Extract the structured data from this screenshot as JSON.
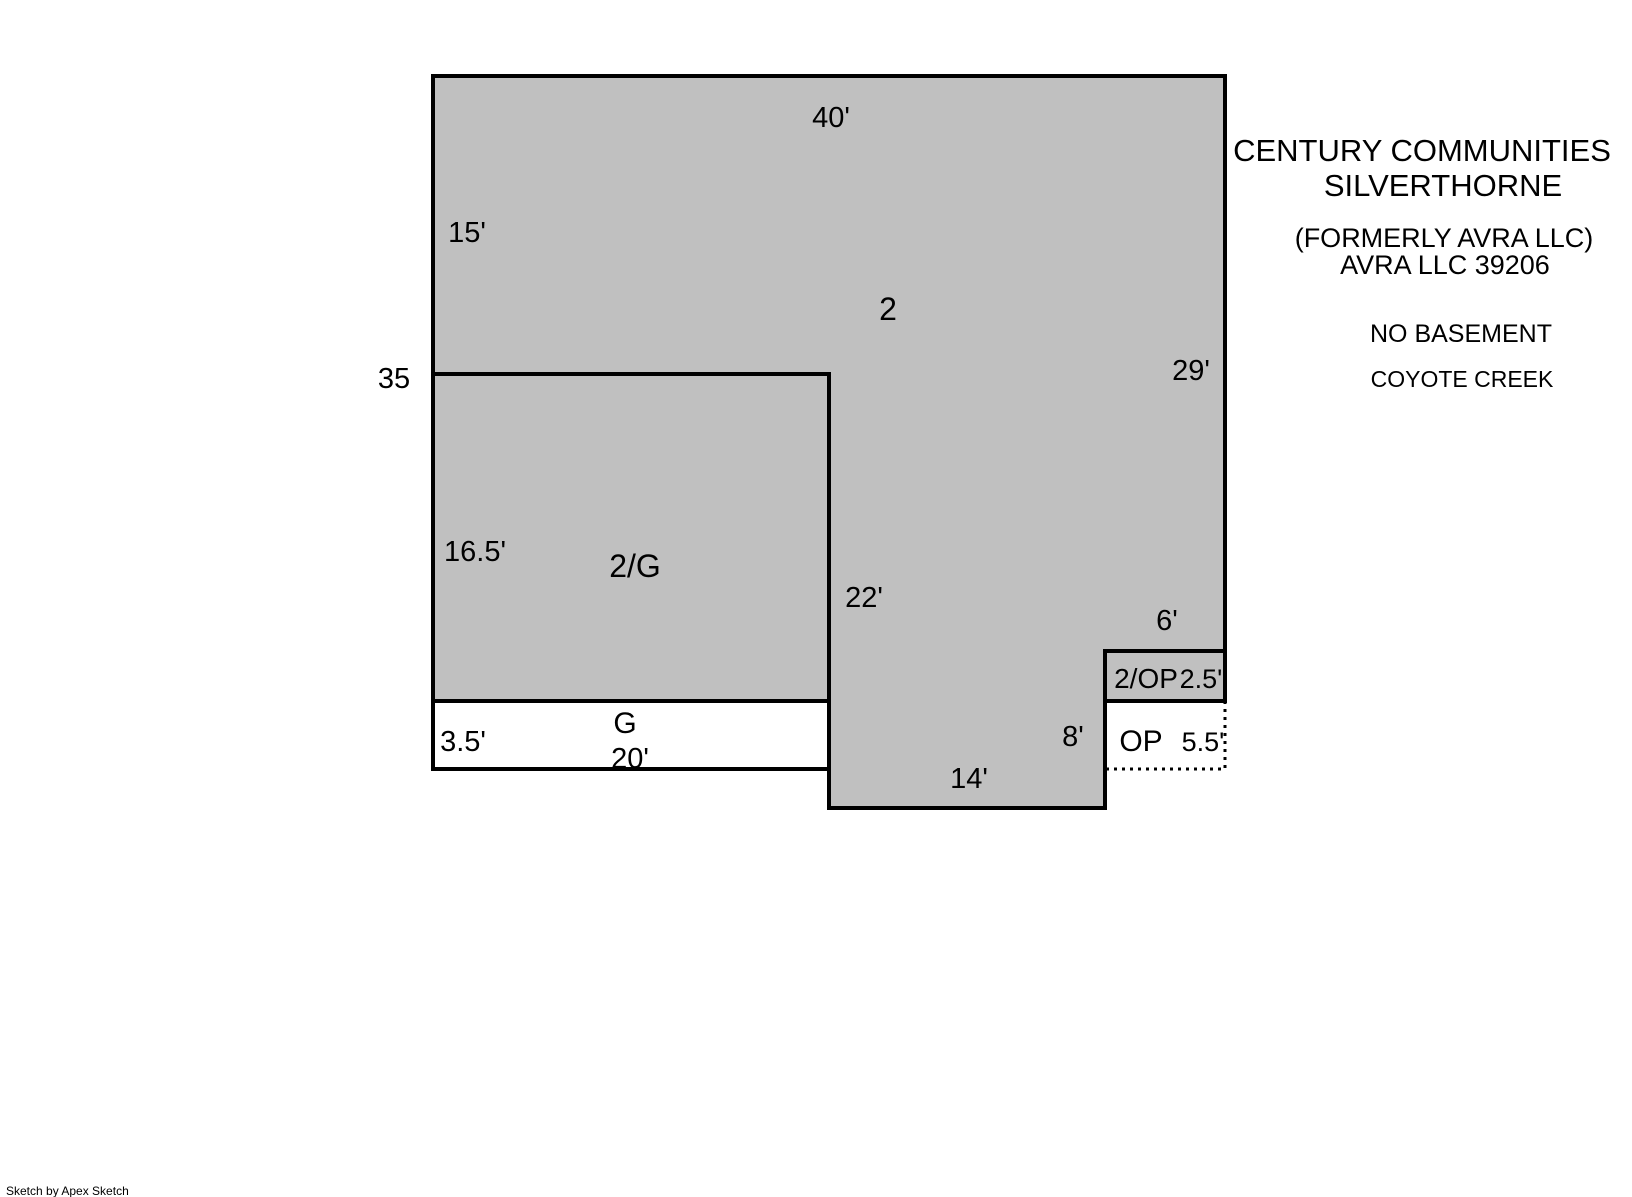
{
  "colors": {
    "area_fill": "#c0c0c0",
    "line": "#000000",
    "background": "#ffffff"
  },
  "floorplan": {
    "areas": {
      "second_floor": "2",
      "second_over_garage": "2/G",
      "garage": "G",
      "second_over_open_porch": "2/OP",
      "open_porch": "OP"
    },
    "dimensions": {
      "top_width": "40'",
      "left_upper": "15'",
      "left_total": "35",
      "left_middle": "16.5'",
      "left_lower": "3.5'",
      "garage_width": "20'",
      "right_upper": "29'",
      "interior_vertical": "22'",
      "porch_top": "6'",
      "porch_upper_height": "2.5'",
      "wall_lower": "8'",
      "porch_height": "5.5'",
      "bottom_center": "14'"
    }
  },
  "title_block": {
    "line1": "CENTURY COMMUNITIES",
    "line2": "SILVERTHORNE",
    "line3": "(FORMERLY AVRA LLC)",
    "line4": "AVRA LLC 39206",
    "line5": "NO BASEMENT",
    "line6": "COYOTE CREEK"
  },
  "footer": {
    "credit": "Sketch by Apex Sketch"
  }
}
